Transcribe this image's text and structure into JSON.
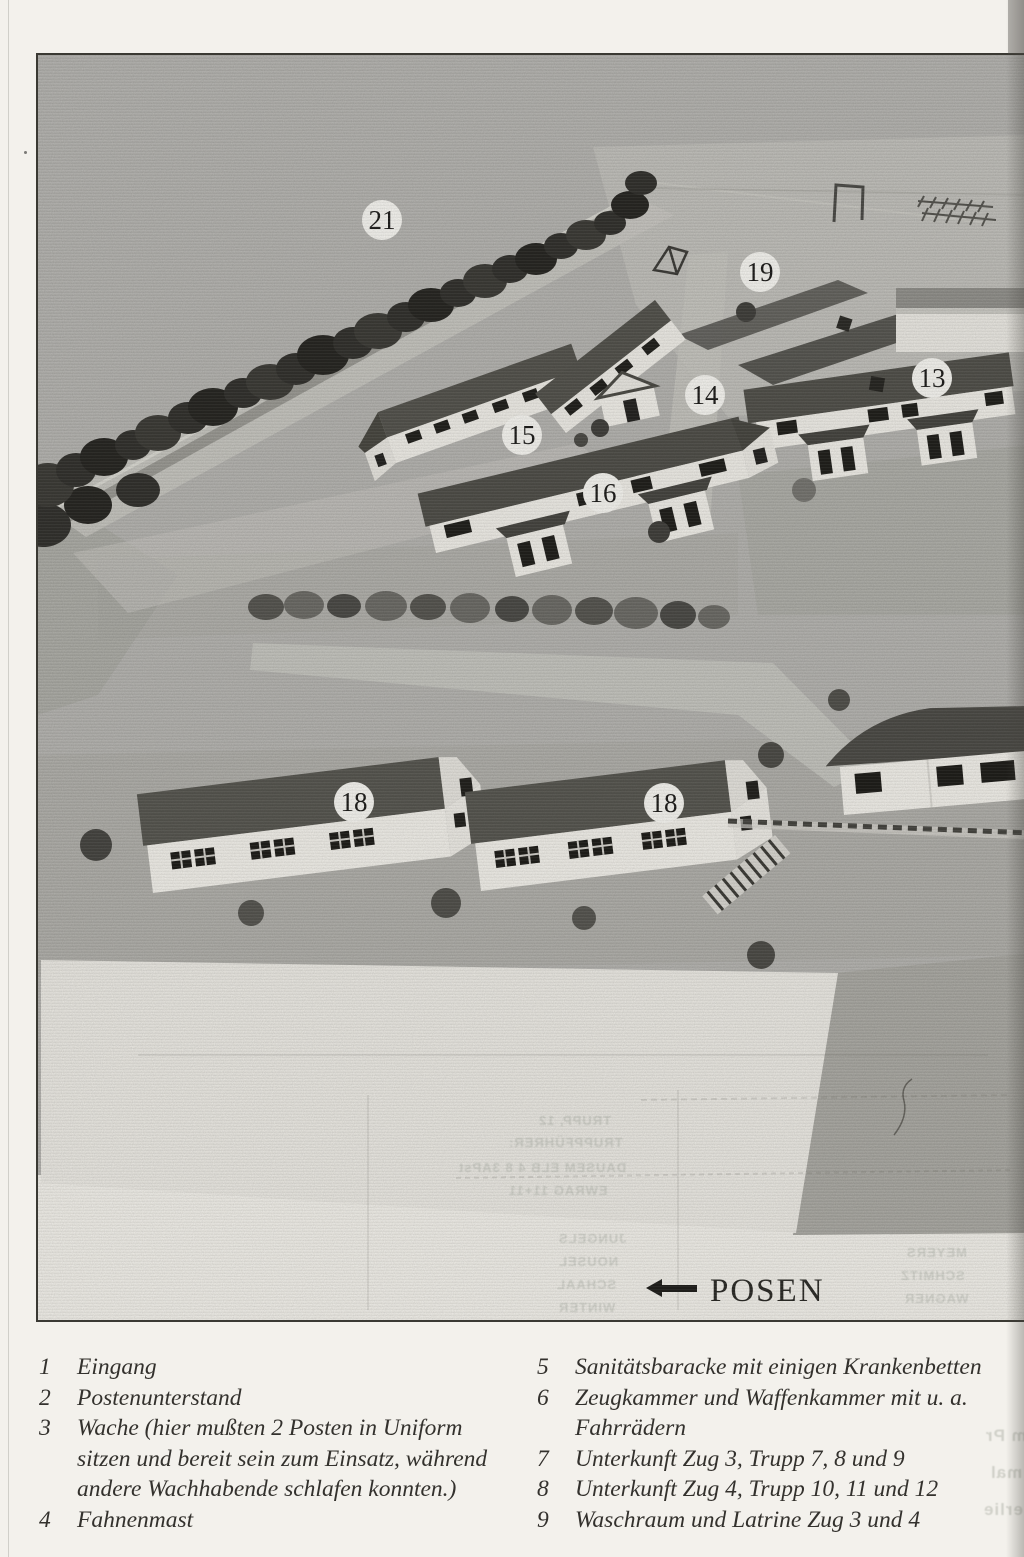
{
  "figure": {
    "labels": [
      {
        "number": "21"
      },
      {
        "number": "19"
      },
      {
        "number": "13"
      },
      {
        "number": "14"
      },
      {
        "number": "15"
      },
      {
        "number": "16"
      },
      {
        "number": "18"
      },
      {
        "number": "18"
      }
    ],
    "posen": {
      "arrow": "left-arrow",
      "label": "POSEN"
    },
    "colors": {
      "photo_background": "#b3b2ae",
      "tree": "#31302c",
      "roof": "#504f49",
      "wall": "#eeece6",
      "window": "#201f1b",
      "road": "#c6c5bf",
      "page": "#f3f1ec",
      "text": "#33312d"
    }
  },
  "ghost_text": {
    "g1": "TRUPP, 12",
    "g2": "TRUPPFÜHRER:",
    "g3": "DAUSEM ELB 4 8 3APst",
    "g4": "EWRAG  11+11",
    "g5": "JUNGELS",
    "g6": "NOUSEL",
    "g7": "SCHAAL",
    "g8": "WINTER",
    "g9": "MEYERS",
    "g10": "SCHMITZ",
    "g11": "WAGNER",
    "g12": "Im Pr",
    "g13": "mal",
    "g14": "nerlie"
  },
  "legend": {
    "items": [
      {
        "number": "1",
        "text": "Eingang"
      },
      {
        "number": "2",
        "text": "Postenunterstand"
      },
      {
        "number": "3",
        "text": "Wache (hier mußten 2 Posten in Uniform sitzen und bereit sein zum Einsatz, während andere Wachhabende schlafen konnten.)"
      },
      {
        "number": "4",
        "text": "Fahnenmast"
      },
      {
        "number": "5",
        "text": "Sanitätsbaracke mit einigen Krankenbetten"
      },
      {
        "number": "6",
        "text": "Zeugkammer und Waffenkammer mit u. a. Fahrrädern"
      },
      {
        "number": "7",
        "text": "Unterkunft Zug 3, Trupp 7, 8 und 9"
      },
      {
        "number": "8",
        "text": "Unterkunft Zug 4, Trupp 10, 11 und 12"
      },
      {
        "number": "9",
        "text": "Waschraum und Latrine Zug 3 und 4"
      }
    ]
  }
}
